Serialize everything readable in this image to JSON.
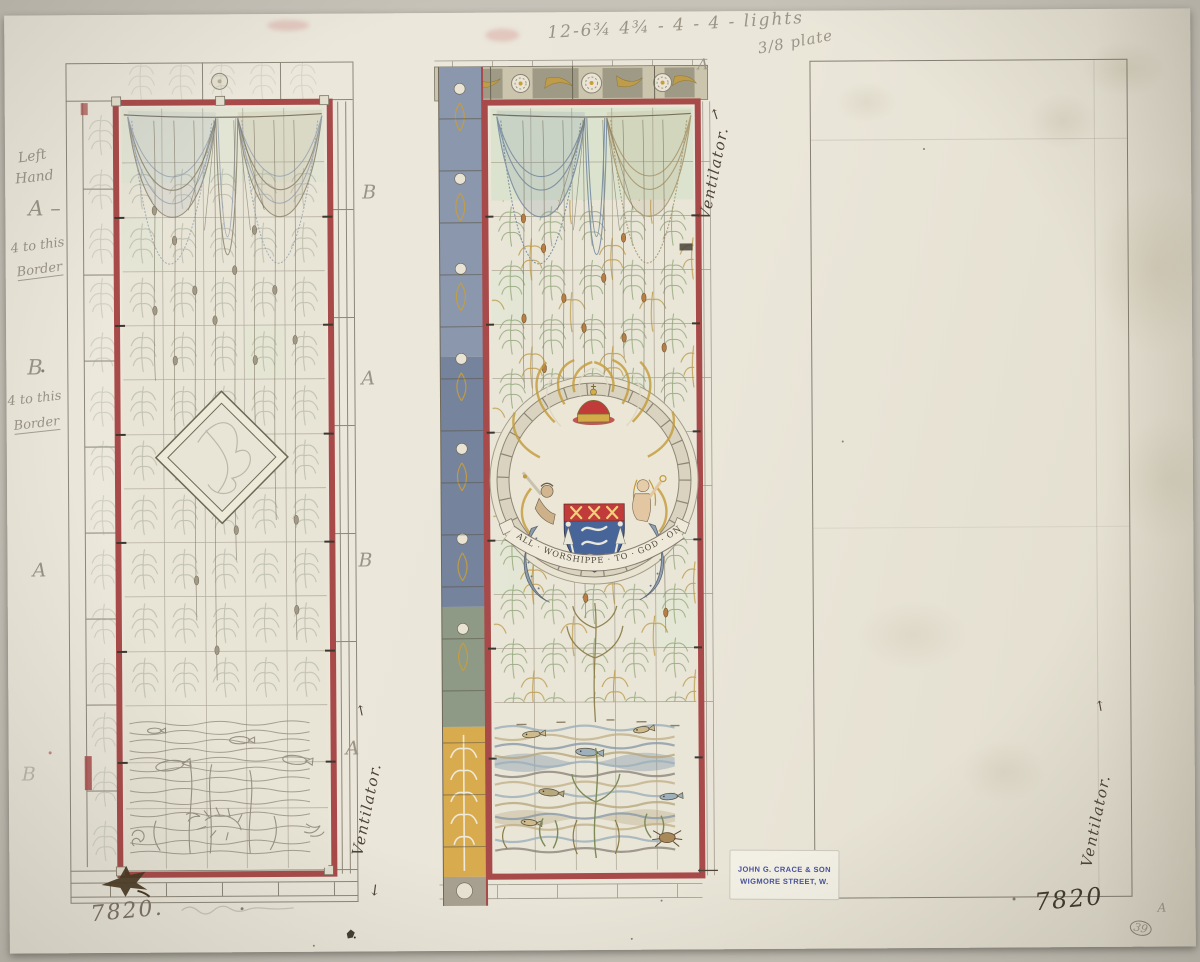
{
  "palette": {
    "background": "#c6c2b8",
    "paper": "#eae6d9",
    "pencil": "#9a9486",
    "ink": "#4d4437",
    "red_border": "#a84a49",
    "pale_green": "#d8e2cc",
    "net_blue": "#7d90a2",
    "net_tan": "#ab9c74",
    "gold": "#c89d3b",
    "leaf_green": "#94a87c",
    "shield_blue": "#48659a",
    "shield_red": "#c23b3b",
    "border_blue": "#8b97ad",
    "border_gold": "#d8ab4f",
    "stamp_blue": "#45519b"
  },
  "annotations": {
    "top_measurement": "12-6¾  4¾ - 4 - 4 - lights",
    "top_plate": "3/8 plate",
    "left_margin": {
      "left1": "Left",
      "left2": "Hand",
      "a_dash": "A –",
      "note1a": "4 to this",
      "note1b": "Border",
      "b_upper": "B",
      "note2a": "4 to this",
      "note2b": "Border",
      "a_mid": "A",
      "b_low": "B"
    },
    "mullion": {
      "b1": "B",
      "a1": "A",
      "b2": "B",
      "a2": "A",
      "a_top": "A"
    },
    "ventilator": "Ventilator.",
    "arrows": {
      "up": "↑",
      "down": "↓",
      "left": "⟵"
    },
    "numbers": {
      "bottom_left": "7820.",
      "bottom_right": "7820",
      "circled": "39",
      "corner": "A"
    }
  },
  "stamp": {
    "line1": "JOHN G. CRACE & SON",
    "line2": "WIGMORE STREET, W."
  },
  "medallion": {
    "motto": "ALL · WORSHIPPE · TO · GOD · ONLY"
  }
}
